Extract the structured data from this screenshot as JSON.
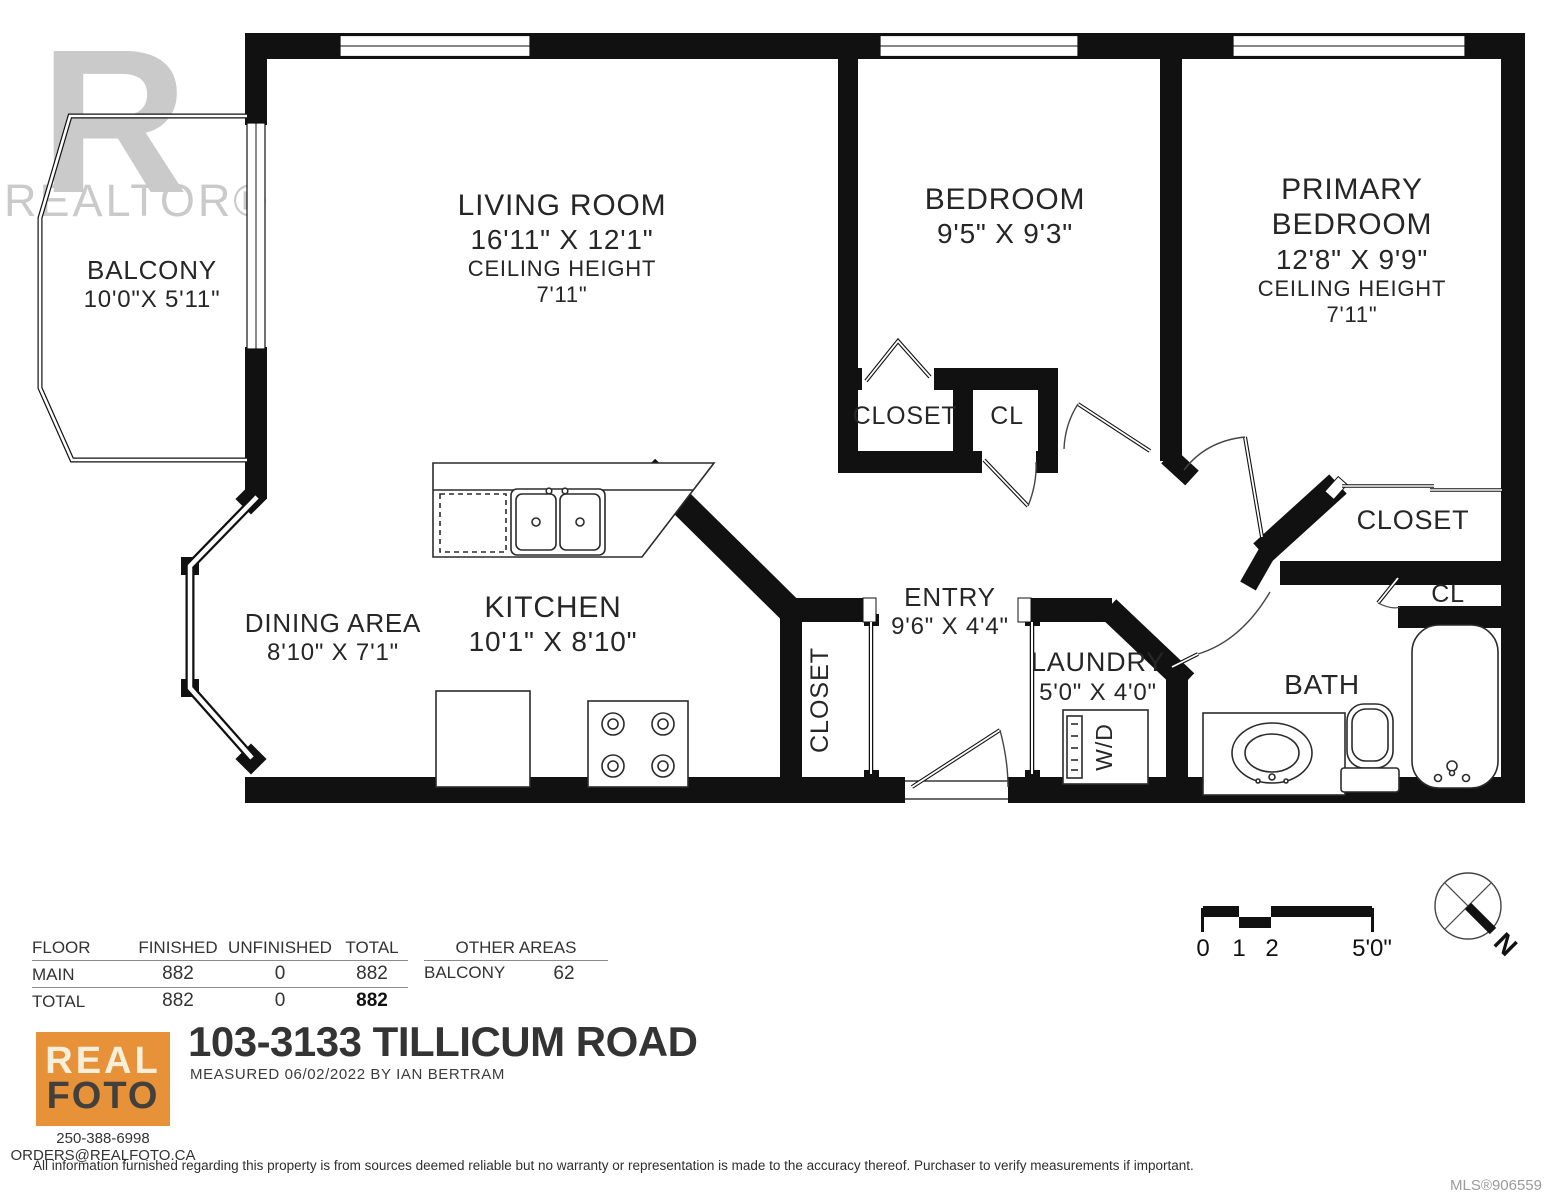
{
  "watermark": {
    "big": "R",
    "text": "REALTOR®"
  },
  "rooms": {
    "balcony": {
      "name": "BALCONY",
      "dims": "10'0\"X 5'11\""
    },
    "living": {
      "name": "LIVING ROOM",
      "dims": "16'11\" X 12'1\"",
      "ceiling_label": "CEILING HEIGHT",
      "ceiling": "7'11\""
    },
    "bedroom": {
      "name": "BEDROOM",
      "dims": "9'5\" X 9'3\""
    },
    "primary": {
      "name1": "PRIMARY",
      "name2": "BEDROOM",
      "dims": "12'8\" X 9'9\"",
      "ceiling_label": "CEILING HEIGHT",
      "ceiling": "7'11\""
    },
    "bedroom_closet": {
      "name": "CLOSET"
    },
    "bedroom_cl": {
      "name": "CL"
    },
    "dining": {
      "name": "DINING AREA",
      "dims": "8'10\" X 7'1\""
    },
    "kitchen": {
      "name": "KITCHEN",
      "dims": "10'1\" X 8'10\""
    },
    "entry": {
      "name": "ENTRY",
      "dims": "9'6\" X 4'4\""
    },
    "entry_closet": {
      "name": "CLOSET"
    },
    "laundry": {
      "name": "LAUNDRY",
      "dims": "5'0\" X 4'0\"",
      "wd": "W/D"
    },
    "bath": {
      "name": "BATH"
    },
    "primary_closet": {
      "name": "CLOSET"
    },
    "bath_cl": {
      "name": "CL"
    }
  },
  "areas_table": {
    "headers": {
      "floor": "FLOOR",
      "finished": "FINISHED",
      "unfinished": "UNFINISHED",
      "total": "TOTAL"
    },
    "rows": [
      {
        "floor": "MAIN",
        "finished": "882",
        "unfinished": "0",
        "total": "882"
      },
      {
        "floor": "TOTAL",
        "finished": "882",
        "unfinished": "0",
        "total": "882"
      }
    ],
    "other_header": "OTHER AREAS",
    "other_rows": [
      {
        "name": "BALCONY",
        "value": "62"
      }
    ]
  },
  "scale_bar": {
    "labels": [
      "0",
      "1",
      "2",
      "5'0\""
    ]
  },
  "compass": {
    "north": "N"
  },
  "footer": {
    "logo_line1": "REAL",
    "logo_line2": "FOTO",
    "phone": "250-388-6998",
    "email": "ORDERS@REALFOTO.CA",
    "title": "103-3133 TILLICUM ROAD",
    "measured": "MEASURED  06/02/2022   BY IAN BERTRAM",
    "disclaimer": "All information furnished regarding this property is from sources deemed reliable but no warranty or representation is made to the accuracy thereof. Purchaser to verify measurements if important.",
    "mls": "MLS®906559"
  }
}
